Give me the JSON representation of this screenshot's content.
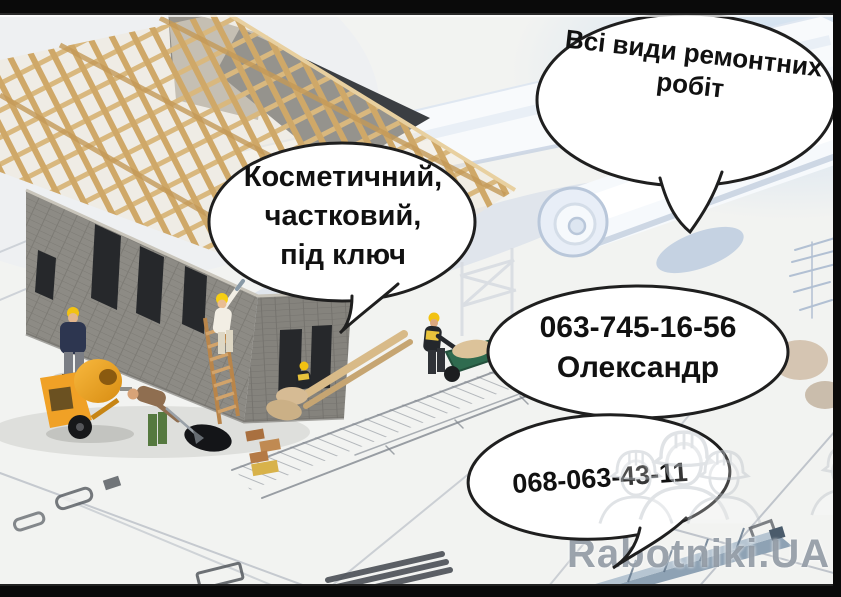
{
  "bubbles": {
    "all_works": {
      "line1": "Всі види ремонтних",
      "line2": "робіт"
    },
    "work_types": {
      "line1": "Косметичний,",
      "line2": "частковий,",
      "line3": "під ключ"
    },
    "contact_main": {
      "phone": "063-745-16-56",
      "name": "Олександр"
    },
    "contact_alt": {
      "phone": "068-063-43-11"
    }
  },
  "watermark": {
    "brand": "Rabotniki.UA",
    "icon": "construction-workers-trio-icon"
  },
  "colors": {
    "letterbox": "#0a0a0a",
    "bubble_fill": "#ffffff",
    "bubble_outline": "#1f1f1f",
    "bubble_text": "#111111",
    "watermark_gray": "#8a939e",
    "helmet_yellow": "#f2c211",
    "mixer_orange": "#f0a126",
    "truss_wood": "#d9ba82",
    "wall_gray": "#8d8b85",
    "blueprint_line": "#aeb4bd"
  }
}
